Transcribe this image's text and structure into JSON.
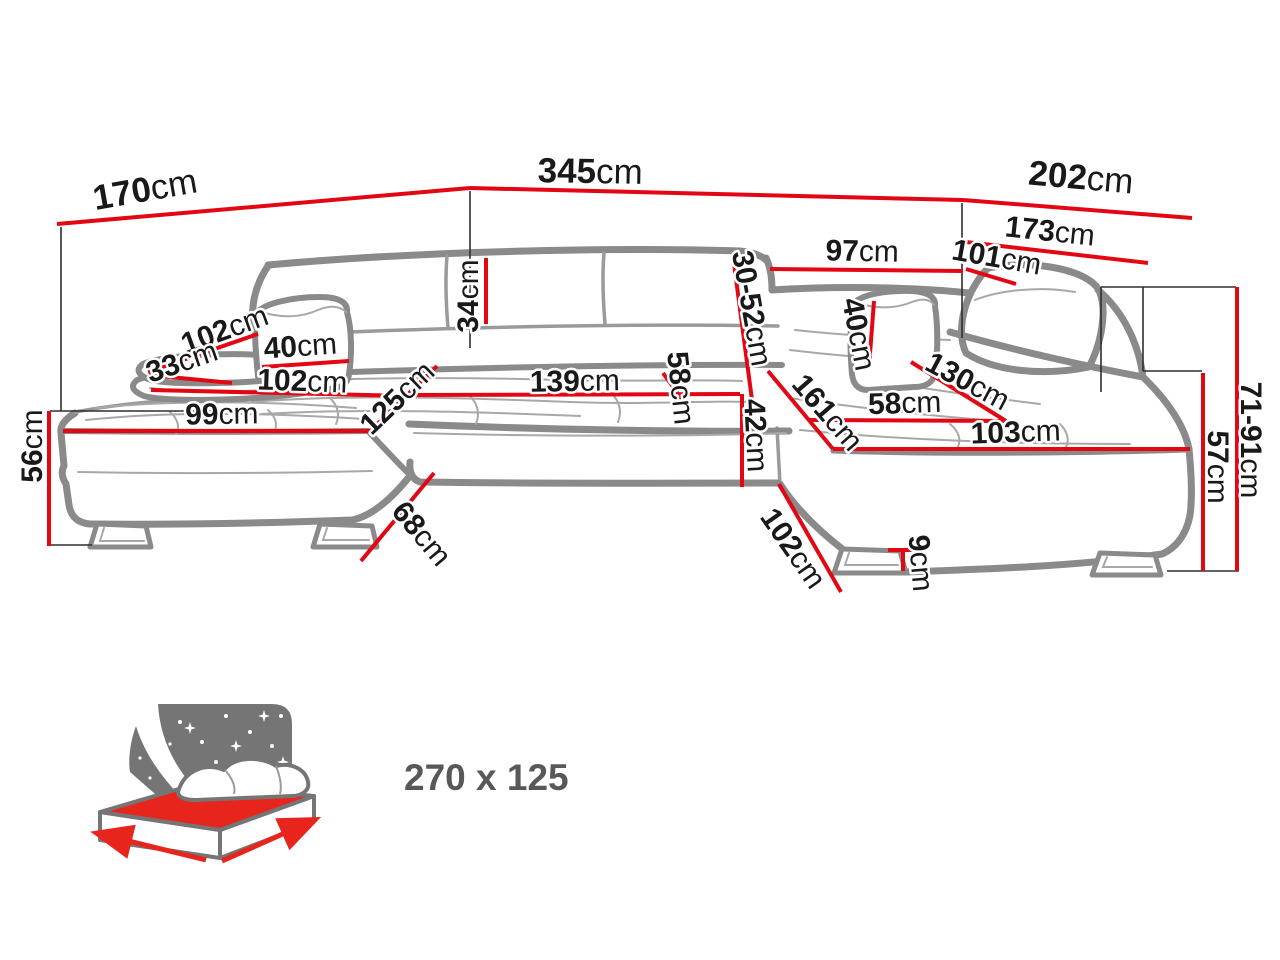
{
  "colors": {
    "dimension_line": "#e30613",
    "sofa_outline": "#8a8a8a",
    "reference_line": "#2f2f2f",
    "label_text": "#191919",
    "bed_icon_gray": "#757575",
    "bed_mattress_red": "#e8251c",
    "sleeping_size_text": "#585858",
    "background": "#ffffff"
  },
  "icons": {
    "sleeping_function": "bed-with-stars-icon"
  },
  "dims": {
    "w_total": {
      "v": "345",
      "u": "cm"
    },
    "d_left": {
      "v": "170",
      "u": "cm"
    },
    "d_right": {
      "v": "202",
      "u": "cm"
    },
    "d_right_in": {
      "v": "173",
      "u": "cm"
    },
    "w_back": {
      "v": "97",
      "u": "cm"
    },
    "w_corner": {
      "v": "101",
      "u": "cm"
    },
    "h_backrest": {
      "v": "34",
      "u": "cm"
    },
    "h_headrest": {
      "v": "30-52",
      "u": "cm"
    },
    "len_arm_l": {
      "v": "102",
      "u": "cm"
    },
    "w_arm_l": {
      "v": "33",
      "u": "cm"
    },
    "w_pillow_l": {
      "v": "40",
      "u": "cm"
    },
    "len_seat_l": {
      "v": "102",
      "u": "cm"
    },
    "len_front_l": {
      "v": "99",
      "u": "cm"
    },
    "diag_l": {
      "v": "125",
      "u": "cm"
    },
    "w_seat_mid": {
      "v": "139",
      "u": "cm"
    },
    "d_seat_mid": {
      "v": "58",
      "u": "cm"
    },
    "h_seat_front": {
      "v": "42",
      "u": "cm"
    },
    "diag_r": {
      "v": "161",
      "u": "cm"
    },
    "d_seat_r": {
      "v": "58",
      "u": "cm"
    },
    "diag_chaise_r": {
      "v": "130",
      "u": "cm"
    },
    "len_seat_r": {
      "v": "103",
      "u": "cm"
    },
    "w_pillow_r": {
      "v": "40",
      "u": "cm"
    },
    "len_bottom_r": {
      "v": "102",
      "u": "cm"
    },
    "h_leg": {
      "v": "9",
      "u": "cm"
    },
    "h_left": {
      "v": "56",
      "u": "cm"
    },
    "diag_bottom_l": {
      "v": "68",
      "u": "cm"
    },
    "h_seat": {
      "v": "57",
      "u": "cm"
    },
    "h_total": {
      "v": "71-91",
      "u": "cm"
    }
  },
  "sleeping_area": {
    "size": "270 x 125"
  }
}
